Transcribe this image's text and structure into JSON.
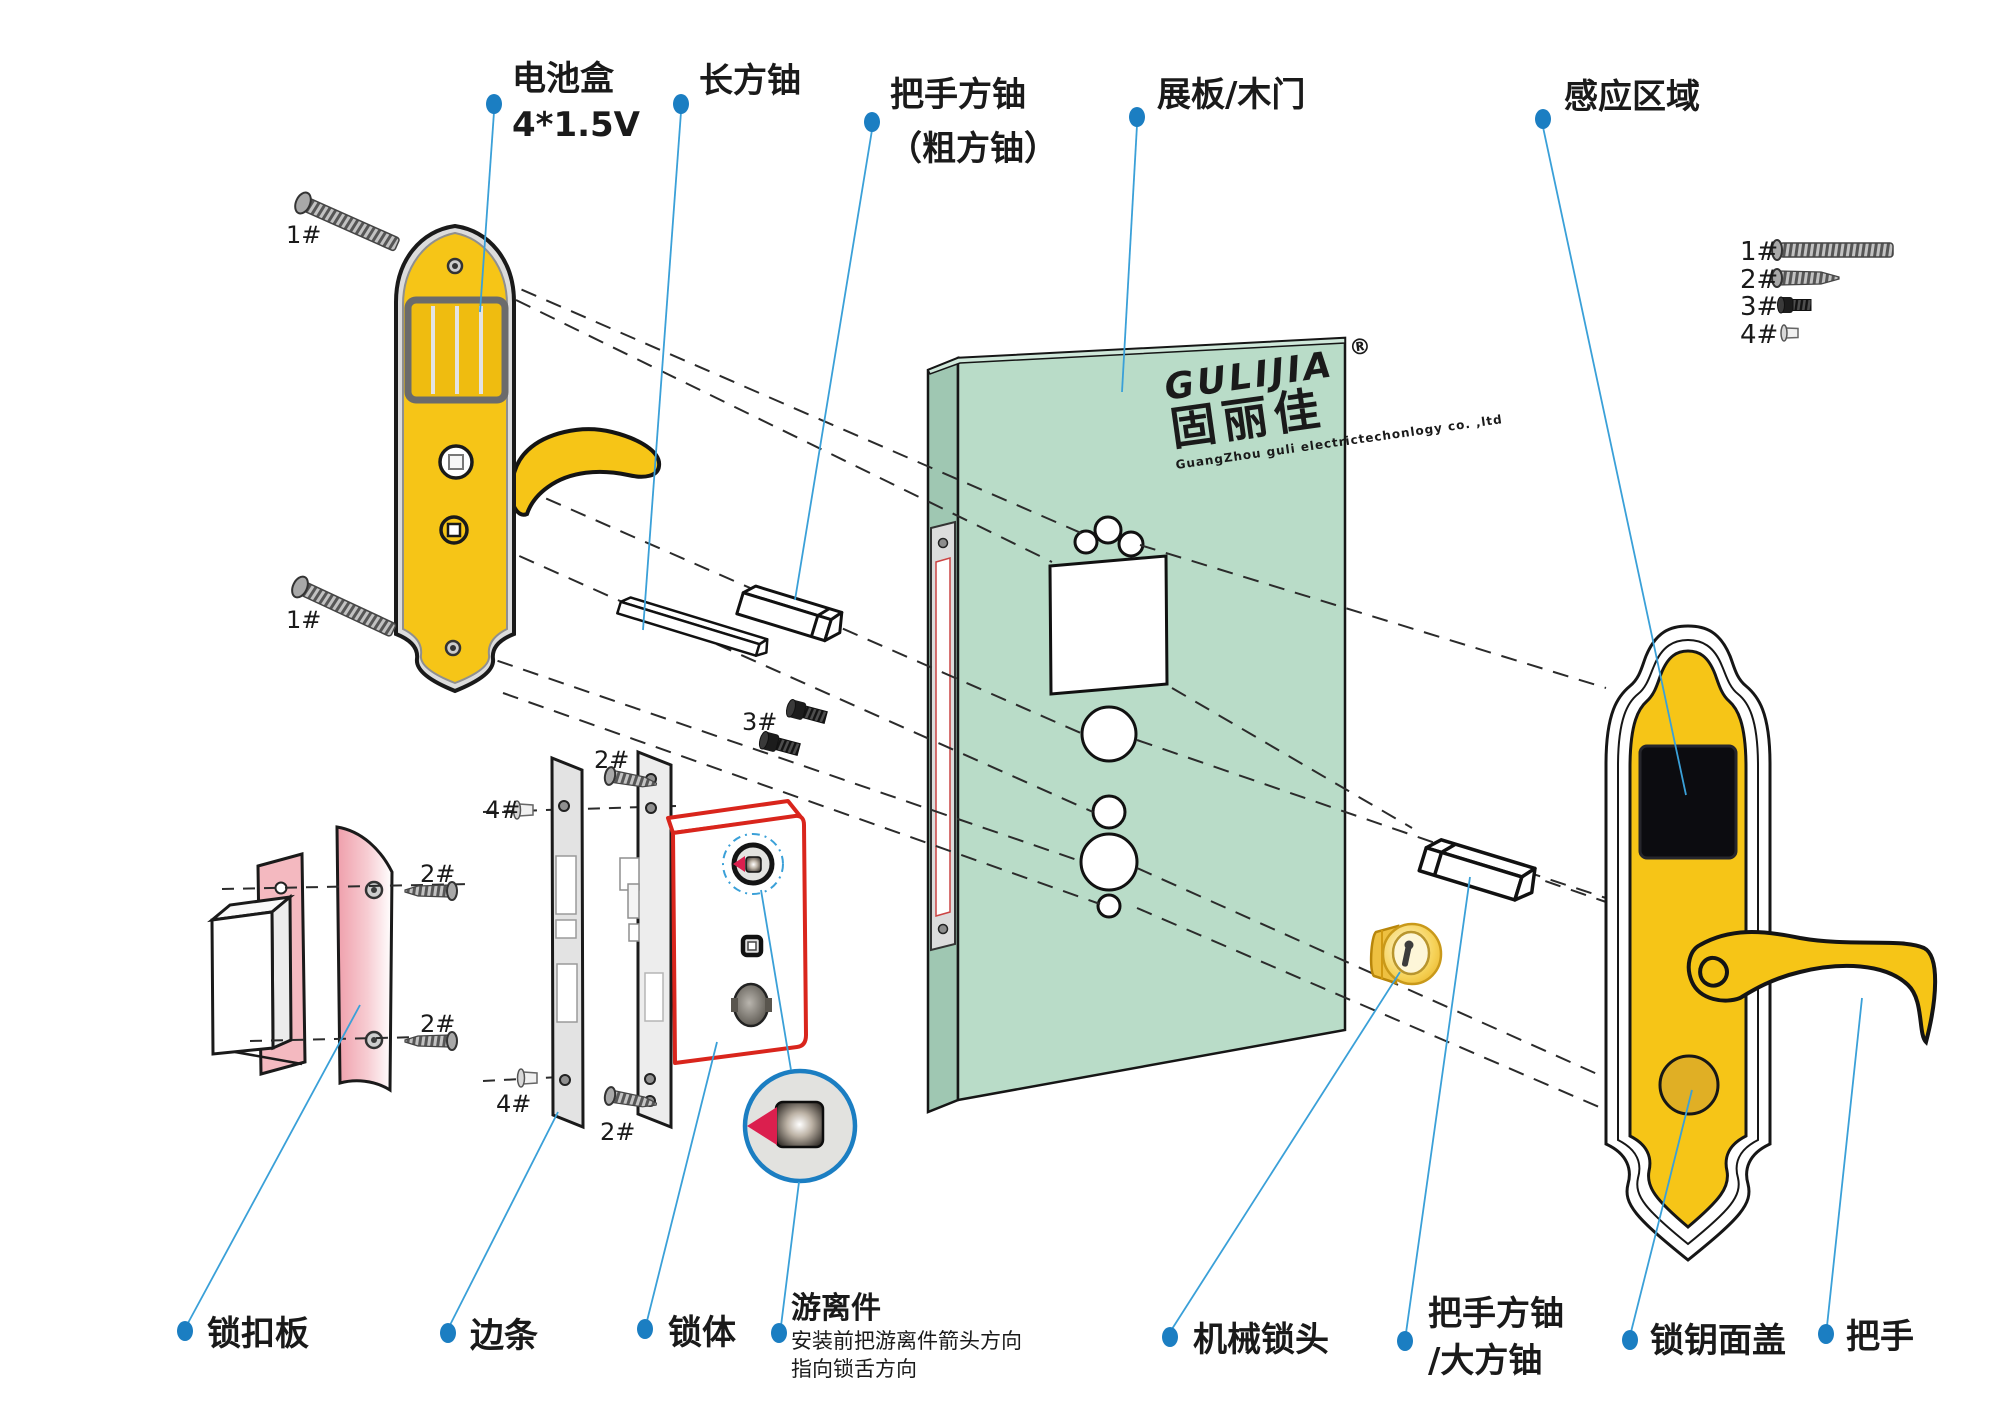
{
  "labels": {
    "battery_box_1": "电池盒",
    "battery_box_2": "4*1.5V",
    "long_spindle": "长方铀",
    "handle_spindle_1": "把手方铀",
    "handle_spindle_2": "（粗方铀）",
    "door_panel": "展板/木门",
    "sensing_area": "感应区域",
    "strike_plate": "锁扣板",
    "edge_strip": "边条",
    "lock_body": "锁体",
    "floating_part": "游离件",
    "floating_part_note_1": "安装前把游离件箭头方向",
    "floating_part_note_2": "指向锁舌方向",
    "mech_cylinder": "机械锁头",
    "big_spindle_1": "把手方铀",
    "big_spindle_2": "/大方铀",
    "key_cover": "锁钥面盖",
    "handle": "把手"
  },
  "screw_ids": {
    "s1": "1#",
    "s2": "2#",
    "s3": "3#",
    "s4": "4#"
  },
  "logo": {
    "brand": "GULIJIA",
    "reg": "®",
    "brand_cn": "固丽佳",
    "company": "GuangZhou guli electrictechonlogy co. ,ltd"
  },
  "colors": {
    "panel_yellow": "#f6c517",
    "door_green": "#b9dcc8",
    "lock_red": "#d9251c",
    "leader_blue": "#3aa0d8",
    "dot_blue": "#1b7ec2",
    "arrow_pink": "#db1f4e",
    "strike_pink": "#f0a3ae"
  }
}
